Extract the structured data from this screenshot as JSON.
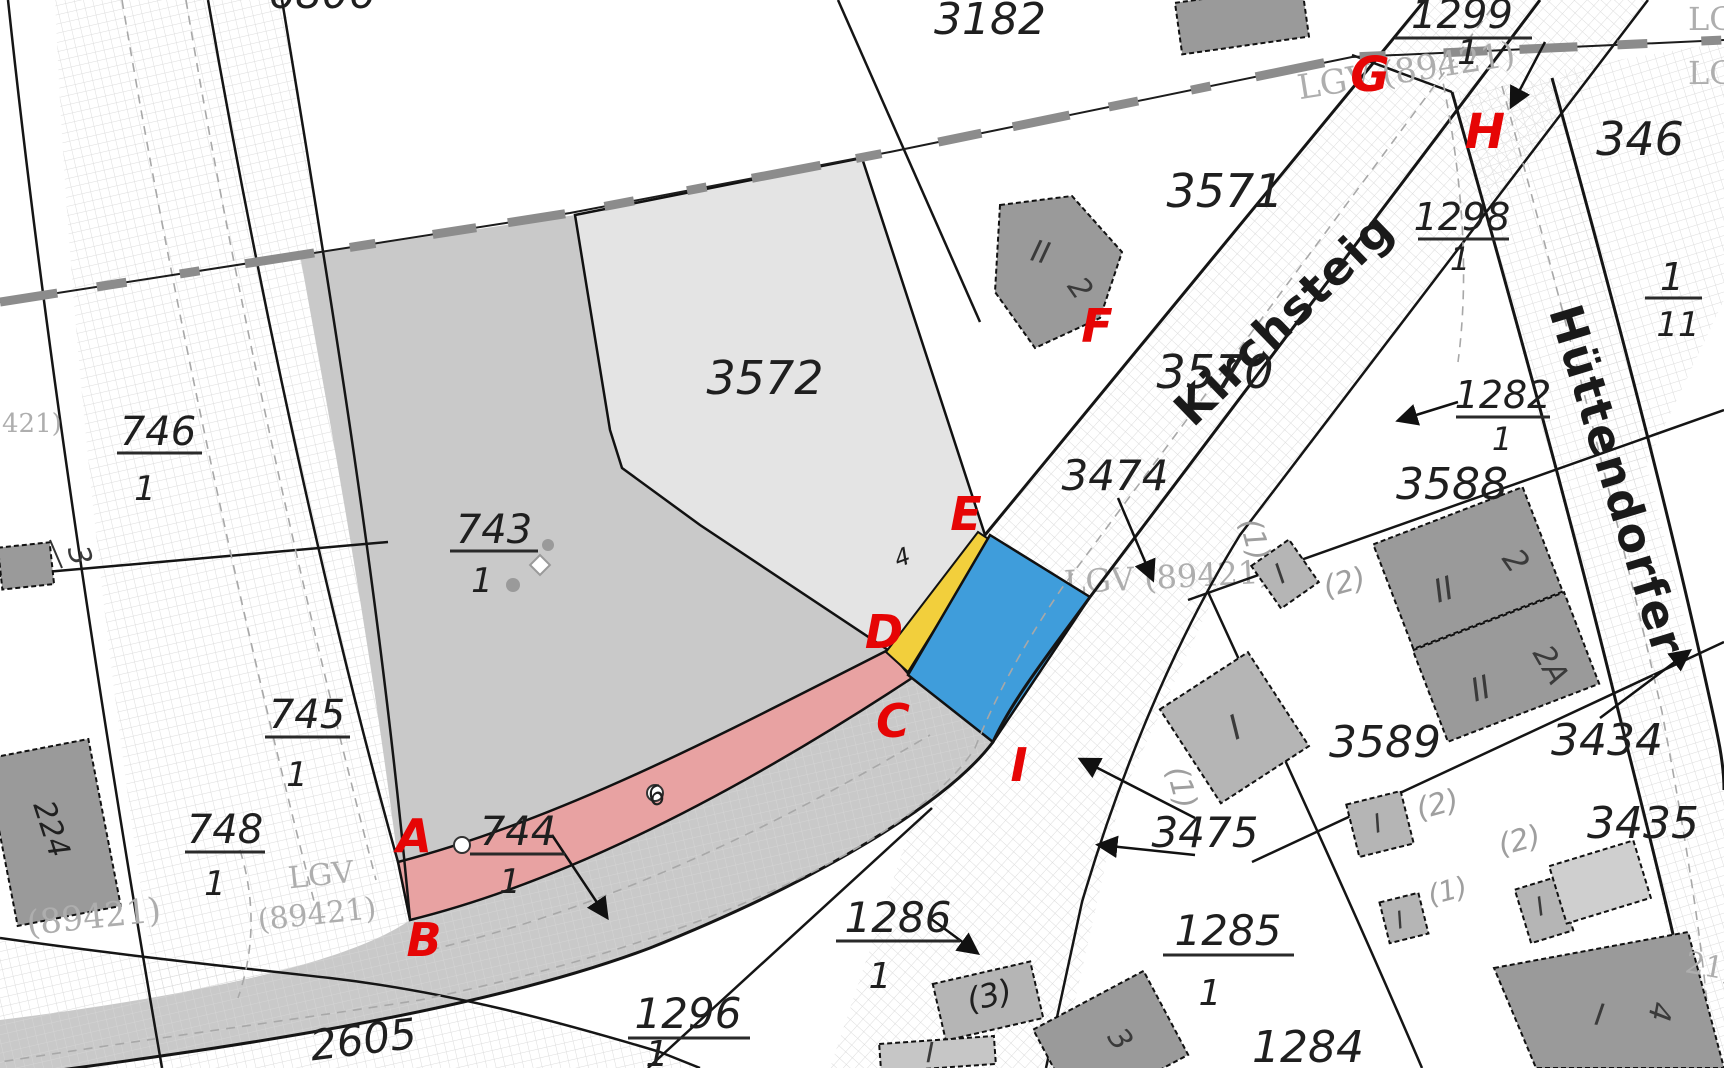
{
  "colors": {
    "parcel_gray_743": "#c9c9c9",
    "parcel_gray_3572": "#e4e4e4",
    "road_band_gray": "#c9c9c9",
    "band_pink": "#e8a2a2",
    "strip_yellow": "#f2cf3c",
    "patch_blue": "#3f9ddb",
    "building_dark": "#9a9a9a",
    "building_mid": "#b5b5b5",
    "building_light": "#cfcfcf",
    "red_mark": "#e60505",
    "boundary_gray": "#8c8c8c"
  },
  "parcels": {
    "p6806": "6806",
    "p3182": "3182",
    "p3571": "3571",
    "p3570": "3570",
    "p3572": "3572",
    "p3474": "3474",
    "p3475": "3475",
    "p3588": "3588",
    "p3589": "3589",
    "p3434": "3434",
    "p3435": "3435",
    "p1284": "1284",
    "p2605": "2605",
    "p224": "224",
    "p346": "346"
  },
  "fractions": {
    "f743": {
      "num": "743",
      "den": "1"
    },
    "f744": {
      "num": "744",
      "den": "1"
    },
    "f745": {
      "num": "745",
      "den": "1"
    },
    "f746": {
      "num": "746",
      "den": "1"
    },
    "f748": {
      "num": "748",
      "den": "1"
    },
    "f1282": {
      "num": "1282",
      "den": "1"
    },
    "f1285": {
      "num": "1285",
      "den": "1"
    },
    "f1286": {
      "num": "1286",
      "den": "1"
    },
    "f1296": {
      "num": "1296",
      "den": "1"
    },
    "f1298": {
      "num": "1298",
      "den": "1"
    },
    "f1299": {
      "num": "1299",
      "den": "1"
    },
    "f1_11": {
      "num": "1",
      "den": "11"
    }
  },
  "red_marks": {
    "A": "A",
    "B": "B",
    "C": "C",
    "D": "D",
    "E": "E",
    "F": "F",
    "G": "G",
    "H": "H",
    "I": "I"
  },
  "streets": {
    "kirchsteig": "Kirchsteig",
    "huettendorfer": "Hüttendorfer"
  },
  "gray_refs": {
    "lgv_word": "LGV",
    "lgv_num": "(89421)",
    "lgv_full_top": "LGV (89421)",
    "lgv_full_mid": "LGV (89421)",
    "lgv_left_num": "(89421)",
    "lg_edge_1": "LG",
    "lg_edge_2": "LG",
    "partial_right": "21)",
    "partial_left": "421)"
  },
  "building_labels": {
    "pent_floors": "II",
    "pent_no": "2",
    "b3588_floors": "II",
    "b3588_no": "2",
    "b3588a_floors": "II",
    "b3588a_no": "2A",
    "i_small_1": "I",
    "i_small_2": "I",
    "i_small_3": "I",
    "i_small_4": "I",
    "i_small_5": "I",
    "i_small_6": "I",
    "i_1296": "I",
    "no3_dark": "3",
    "no3_left": "3",
    "no4": "4",
    "small4": "4",
    "six": "6",
    "ghost1_a": "(1)",
    "ghost1_b": "(1)",
    "ghost1_c": "(1)",
    "ghost2_a": "(2)",
    "ghost2_b": "(2)",
    "ghost2_c": "(2)",
    "ghost3": "(3)"
  }
}
